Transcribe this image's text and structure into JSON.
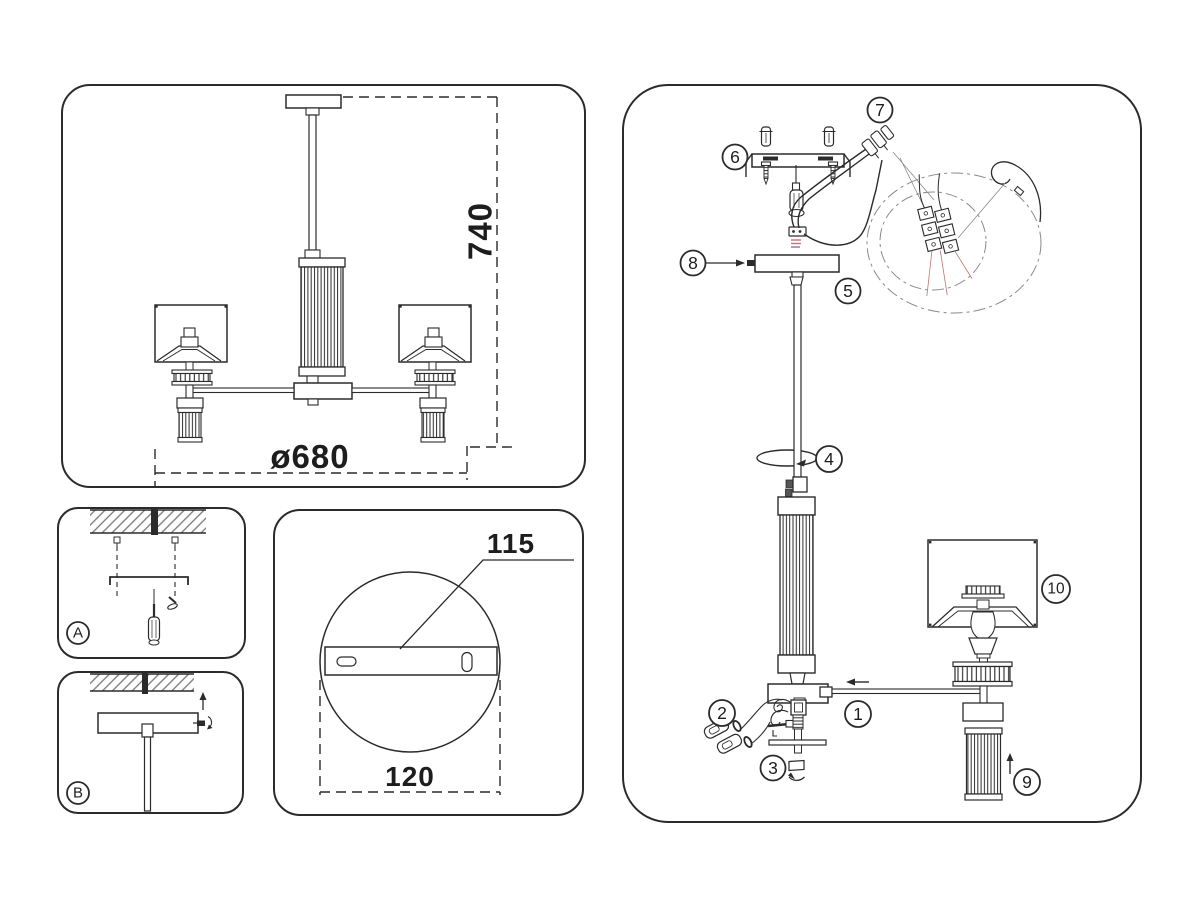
{
  "front_view": {
    "height": "740",
    "diameter": "ø680"
  },
  "mount_a": {
    "label": "A"
  },
  "mount_b": {
    "label": "B"
  },
  "canopy_view": {
    "bracket_width": "115",
    "plate_diameter": "120"
  },
  "exploded": {
    "callouts": {
      "n1": "1",
      "n2": "2",
      "n3": "3",
      "n4": "4",
      "n5": "5",
      "n6": "6",
      "n7": "7",
      "n8": "8",
      "n9": "9",
      "n10": "10"
    }
  },
  "colors": {
    "line": "#2b2b2b",
    "detail_line": "#8a8a8a",
    "wire_red": "#c4736f",
    "wire_purple": "#8f6fa8",
    "background": "#ffffff"
  }
}
